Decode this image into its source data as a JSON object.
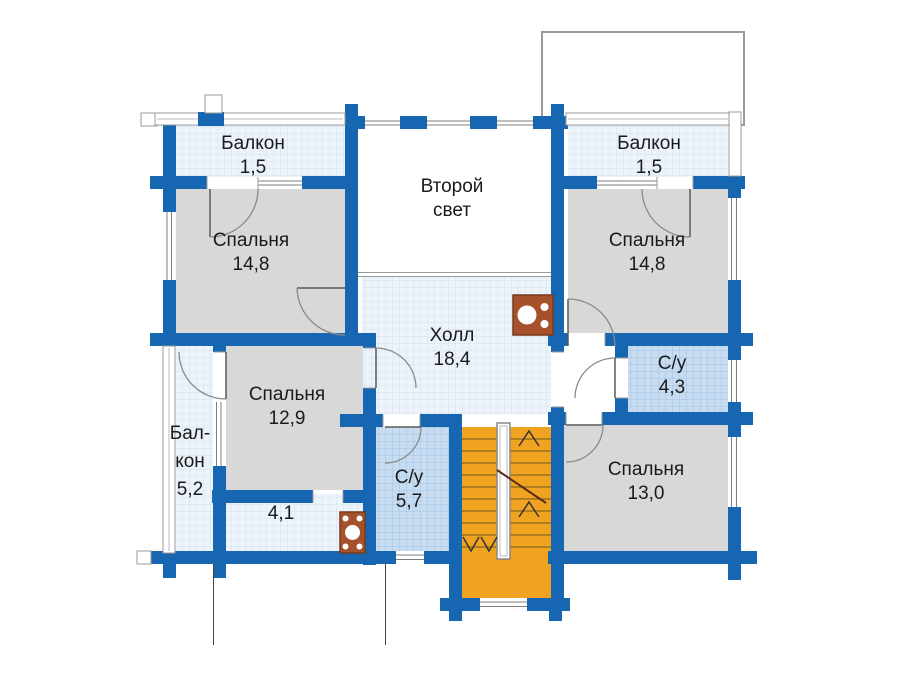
{
  "plan_title": "Floor plan, second storey (Russian labels)",
  "rooms": {
    "balcony_top_left": {
      "name": "Балкон",
      "area": "1,5"
    },
    "balcony_top_right": {
      "name": "Балкон",
      "area": "1,5"
    },
    "second_light": {
      "line1": "Второй",
      "line2": "свет"
    },
    "bedroom_top_left": {
      "name": "Спальня",
      "area": "14,8"
    },
    "bedroom_top_right": {
      "name": "Спальня",
      "area": "14,8"
    },
    "hall": {
      "name": "Холл",
      "area": "18,4"
    },
    "bedroom_middle": {
      "name": "Спальня",
      "area": "12,9"
    },
    "balcony_side": {
      "line1": "Бал-",
      "line2": "кон",
      "area": "5,2"
    },
    "corridor": {
      "area": "4,1"
    },
    "bathroom_center": {
      "name": "С/у",
      "area": "5,7"
    },
    "bathroom_right": {
      "name": "С/у",
      "area": "4,3"
    },
    "bedroom_bottom_right": {
      "name": "Спальня",
      "area": "13,0"
    }
  },
  "colors": {
    "wall_blue": "#1766b2",
    "room_gray": "#d8d8d8",
    "grid_light_bg": "#edf3fa",
    "grid_light_line": "#d4e1f0",
    "wet_room_bg": "#c7dcf1",
    "wet_room_line": "#9fc2e2",
    "stairs_orange": "#f0a320",
    "stove_brown": "#a4512c",
    "outline_gray": "#999999",
    "text": "#1a1a1a"
  },
  "icons": {
    "fireplace": "fireplace-icon",
    "stove": "stove-icon",
    "stairs": "staircase-up"
  }
}
